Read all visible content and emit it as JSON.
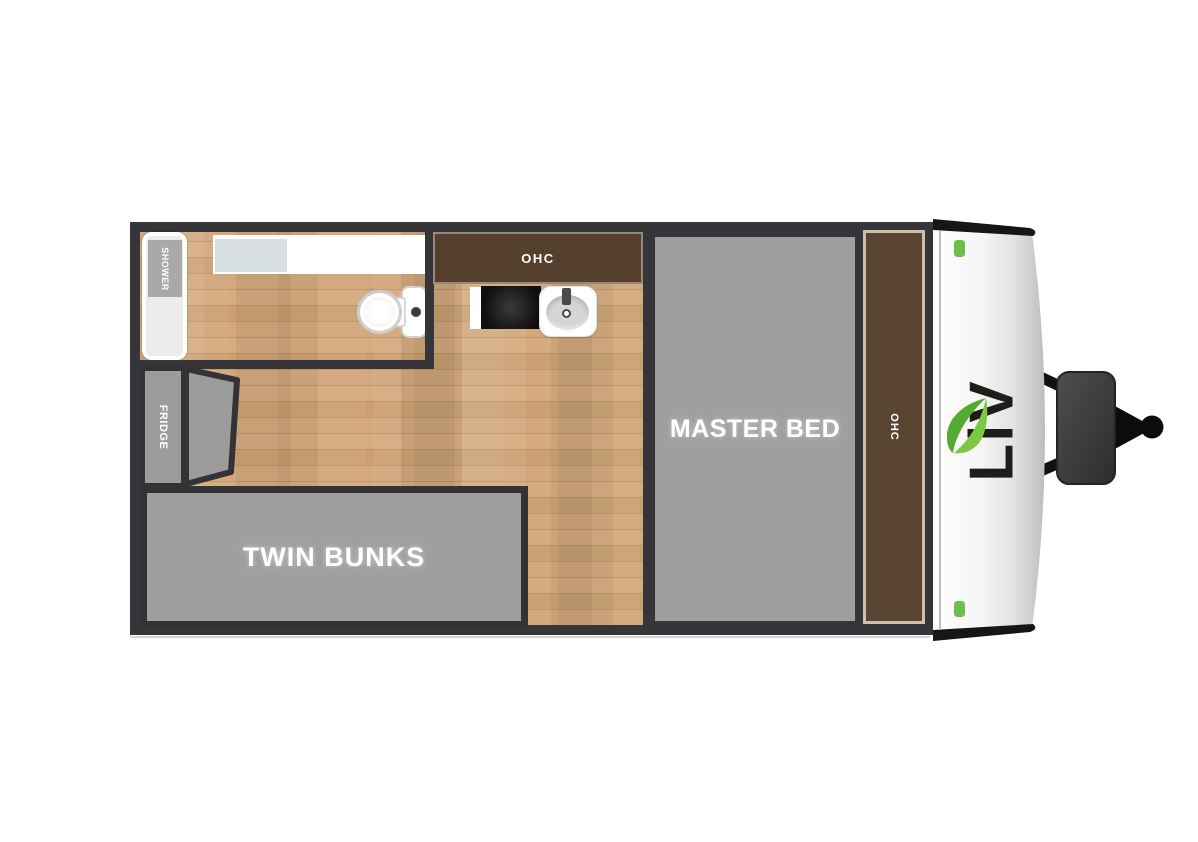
{
  "floorplan": {
    "type": "travel-trailer-floorplan",
    "rooms": {
      "bathroom": {
        "shower_label": "SHOWER"
      },
      "kitchen": {
        "ohc_label": "OHC",
        "fridge_label": "FRIDGE"
      },
      "bunk_area": {
        "label": "TWIN BUNKS"
      },
      "bedroom": {
        "bed_label": "MASTER BED",
        "ohc_label": "OHC"
      }
    },
    "brand": {
      "logo_text": "LiV"
    },
    "colors": {
      "wall": "#36363a",
      "wood": "#cda378",
      "unit_gray": "#9f9f9f",
      "cabinet_brown": "#55402e",
      "cabinet_border_tan": "#cdbfae",
      "counter_white": "#ffffff",
      "sink_blue_gray": "#d7dfe2",
      "accent_green": "#6cc04a",
      "logo_black": "#1d1d1b",
      "hitch_dark": "#3c3c3c"
    }
  }
}
